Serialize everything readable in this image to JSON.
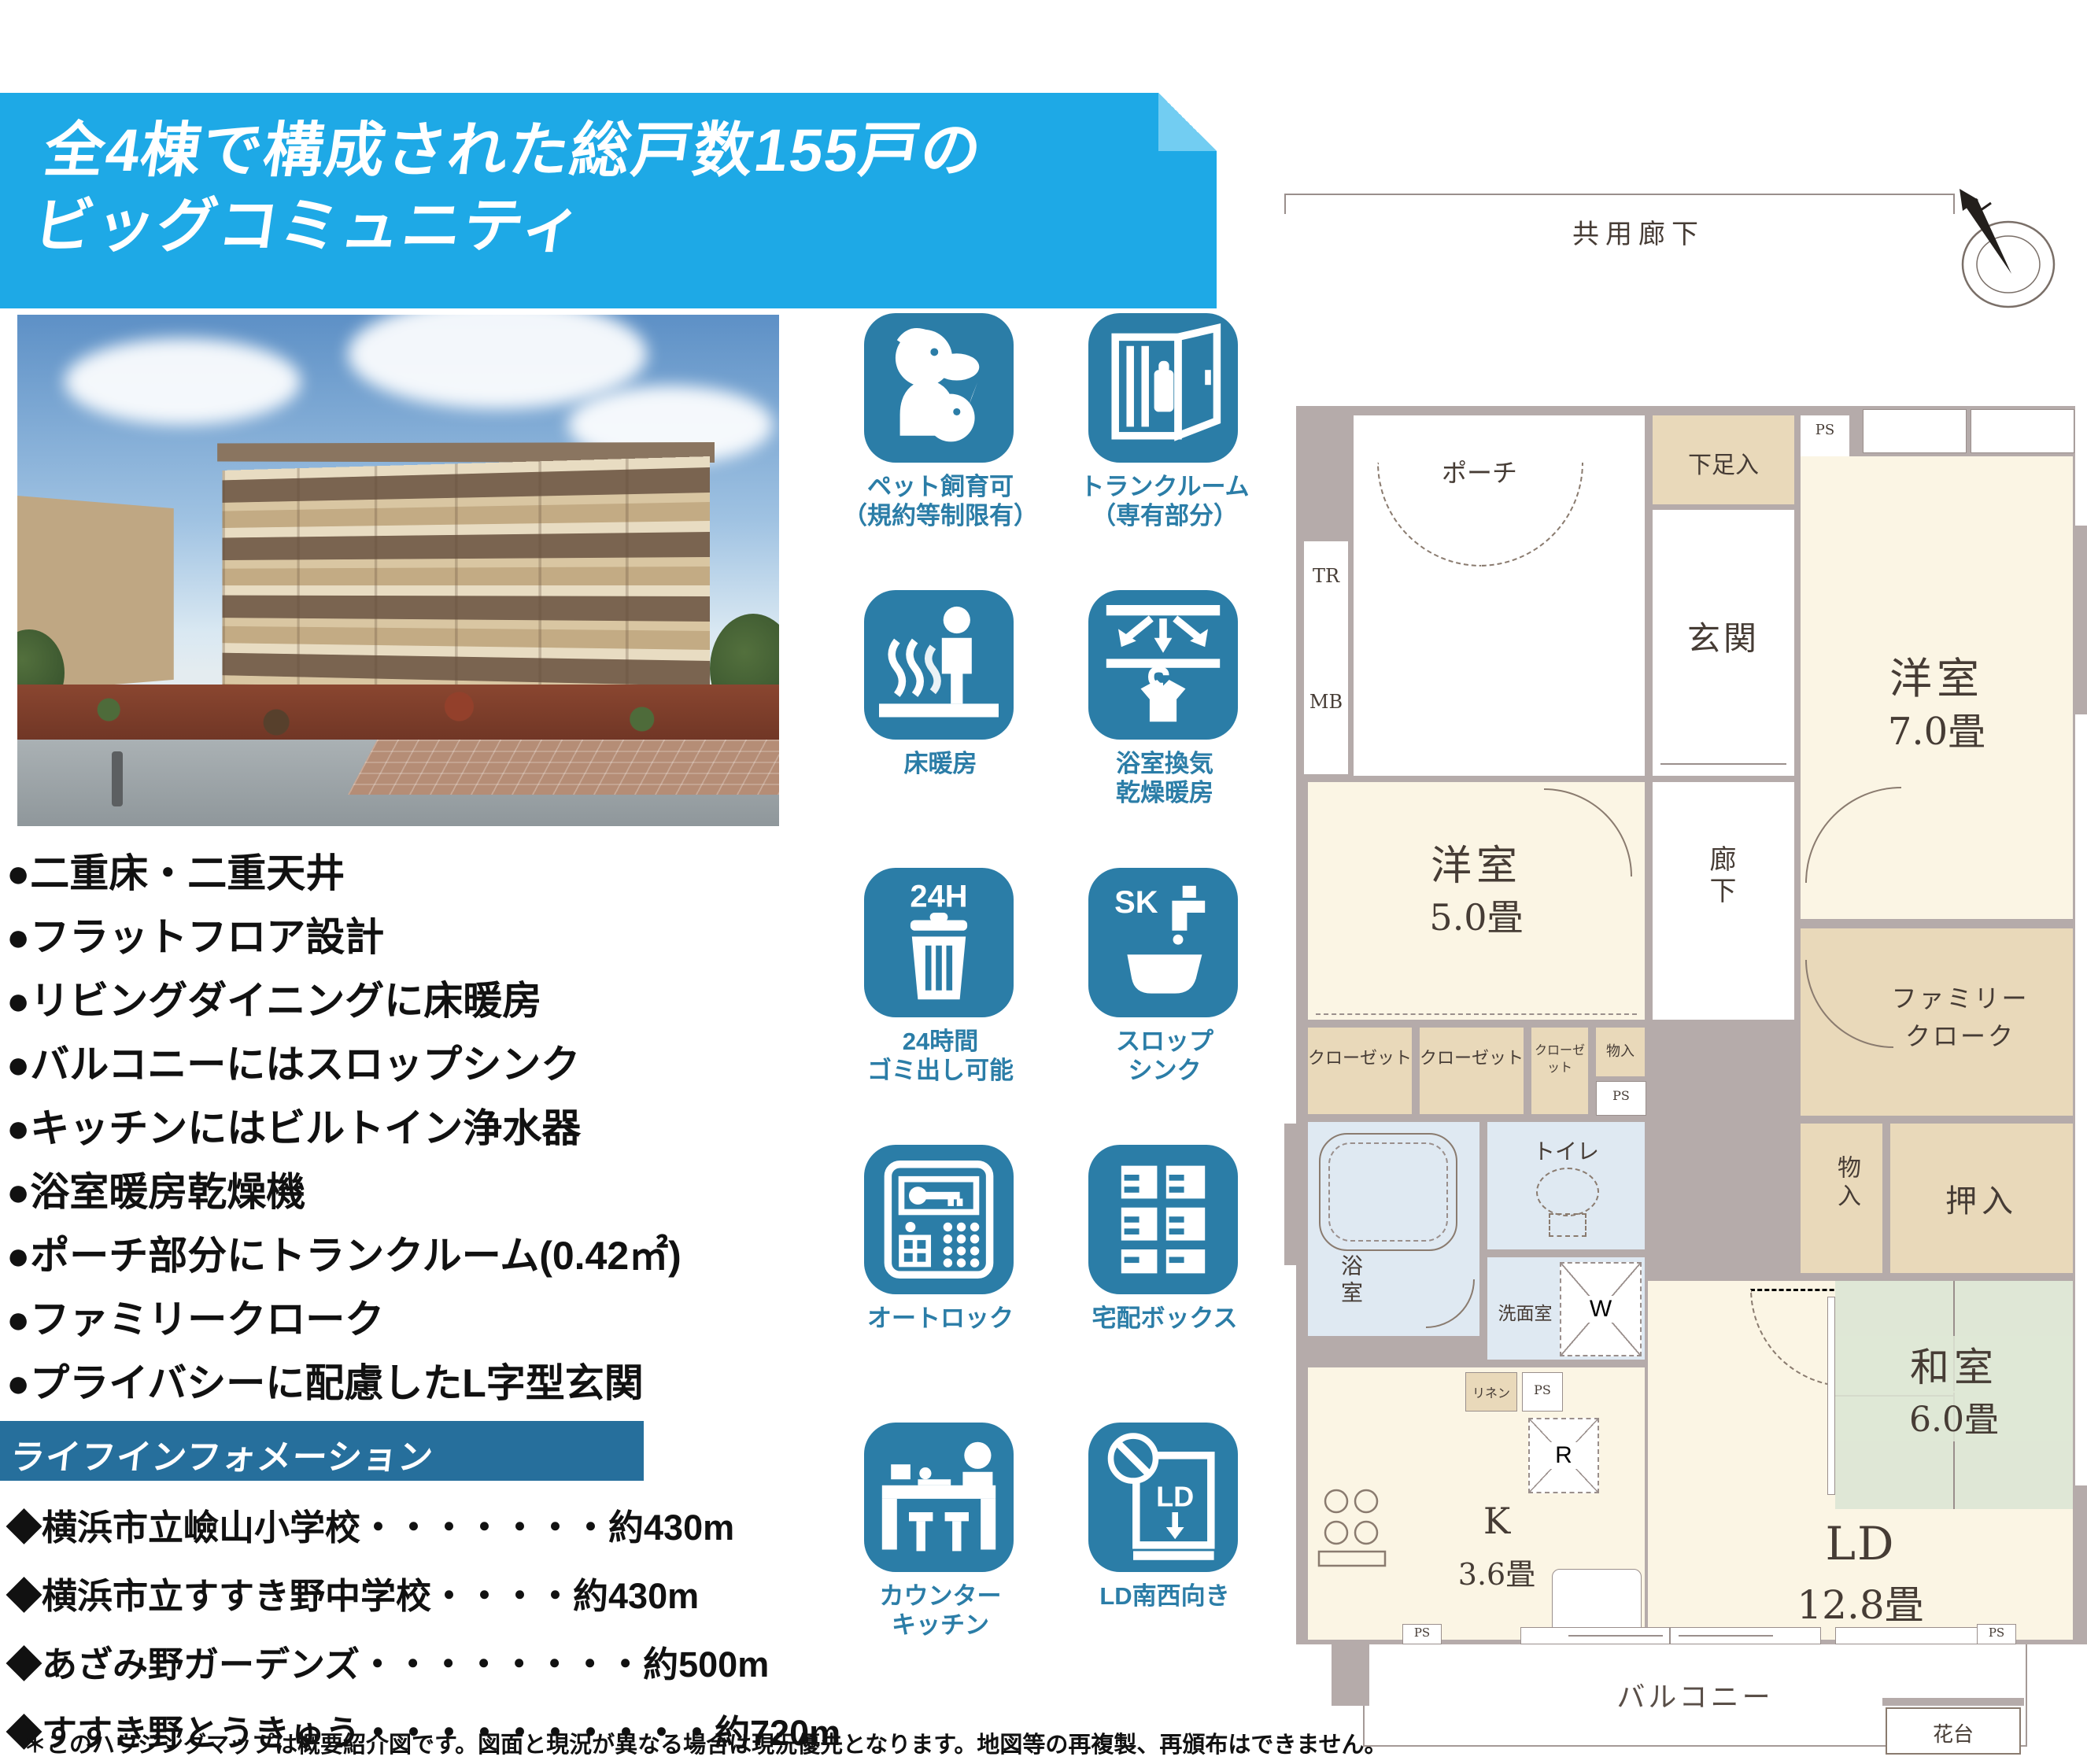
{
  "header": {
    "title_line1": "全4棟で構成された総戸数155戸の",
    "title_line2": "ビッグコミュニティ"
  },
  "features": [
    "●二重床・二重天井",
    "●フラットフロア設計",
    "●リビングダイニングに床暖房",
    "●バルコニーにはスロップシンク",
    "●キッチンにはビルトイン浄水器",
    "●浴室暖房乾燥機",
    "●ポーチ部分にトランクルーム(0.42㎡)",
    "●ファミリークローク",
    "●プライバシーに配慮したL字型玄関"
  ],
  "life_info": {
    "title": "ライフインフォメーション",
    "items": [
      {
        "name": "◆横浜市立嶮山小学校",
        "leader": "・・・・・・・",
        "distance": "約430m"
      },
      {
        "name": "◆横浜市立すすき野中学校",
        "leader": "・・・・",
        "distance": "約430m"
      },
      {
        "name": "◆あざみ野ガーデンズ",
        "leader": "・・・・・・・・",
        "distance": "約500m"
      },
      {
        "name": "◆すすき野とうきゅう",
        "leader": "・・・・・・・・・・",
        "distance": "約720m"
      }
    ]
  },
  "disclaimer": "＊このハウジングマップは概要紹介図です。図面と現況が異なる場合は現況優先となります。地図等の再複製、再頒布はできません。",
  "amenity_icons": [
    {
      "name": "pets-allowed",
      "label1": "ペット飼育可",
      "label2": "（規約等制限有）"
    },
    {
      "name": "trunk-room",
      "label1": "トランクルーム",
      "label2": "（専有部分）"
    },
    {
      "name": "floor-heating",
      "label1": "床暖房",
      "label2": ""
    },
    {
      "name": "bath-ventilation",
      "label1": "浴室換気",
      "label2": "乾燥暖房"
    },
    {
      "name": "garbage-24h",
      "label1": "24時間",
      "label2": "ゴミ出し可能",
      "badge": "24H"
    },
    {
      "name": "slop-sink",
      "label1": "スロップ",
      "label2": "シンク",
      "badge": "SK"
    },
    {
      "name": "auto-lock",
      "label1": "オートロック",
      "label2": ""
    },
    {
      "name": "delivery-box",
      "label1": "宅配ボックス",
      "label2": ""
    },
    {
      "name": "counter-kitchen",
      "label1": "カウンター",
      "label2": "キッチン"
    },
    {
      "name": "ld-southwest",
      "label1": "LD南西向き",
      "label2": "",
      "badge": "LD"
    }
  ],
  "floor_plan": {
    "corridor": "共用廊下",
    "porch": "ポーチ",
    "tr": "TR",
    "mb": "MB",
    "shoe_box": "下足入",
    "ps": "PS",
    "entrance": "玄関",
    "western_room_7": "洋室",
    "western_room_7_size": "7.0畳",
    "western_room_5": "洋室",
    "western_room_5_size": "5.0畳",
    "hallway": "廊下",
    "closet1": "クローゼット",
    "closet2": "クローゼット",
    "closet3": "クローゼット",
    "storage_small_top": "物入",
    "family_cloak_line1": "ファミリー",
    "family_cloak_line2": "クローク",
    "storage_small": "物入",
    "oshiire": "押入",
    "bath": "浴室",
    "toilet": "トイレ",
    "washroom": "洗面室",
    "washer": "W",
    "fridge": "R",
    "linen": "リネン",
    "kitchen": "K",
    "kitchen_size": "3.6畳",
    "japanese_room": "和室",
    "japanese_room_size": "6.0畳",
    "living_dining": "LD",
    "living_dining_size": "12.8畳",
    "balcony": "バルコニー",
    "flower_stand": "花台"
  },
  "colors": {
    "banner_blue": "#1ea9e6",
    "icon_teal": "#2b7da7",
    "bar_teal": "#266f9c",
    "wall_gray": "#b5abaa",
    "room_cream": "#fbf5e4",
    "closet_beige": "#e9d9ba",
    "wet_blue": "#dfe9f2",
    "tatami_green": "#dfe7d6"
  }
}
